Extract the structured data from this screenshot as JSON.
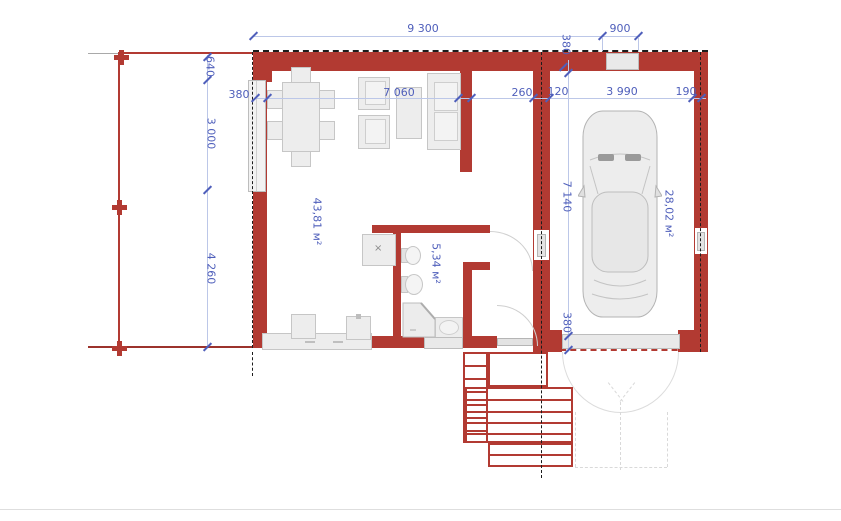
{
  "dims": {
    "w9300": "9 300",
    "w900": "900",
    "wall380_garage_top": "380",
    "left640": "640",
    "left3000": "3 000",
    "left4260": "4 260",
    "wall380_left": "380",
    "room7060": "7 060",
    "hall260": "260",
    "hall120": "120",
    "garage3990": "3 990",
    "garage190": "190",
    "garage7140": "7 140",
    "wall380_garage_bottom": "380"
  },
  "areas": {
    "living_room": "43,81 м²",
    "bathroom": "5,34 м²",
    "garage": "28,02 м²"
  },
  "symbols": {
    "appliance_mark": "×"
  },
  "colors": {
    "wall_red": "#b23a32",
    "dim_text": "#4f5fbb",
    "dim_line": "#bcc7e8",
    "furniture_fill": "#ededed"
  }
}
